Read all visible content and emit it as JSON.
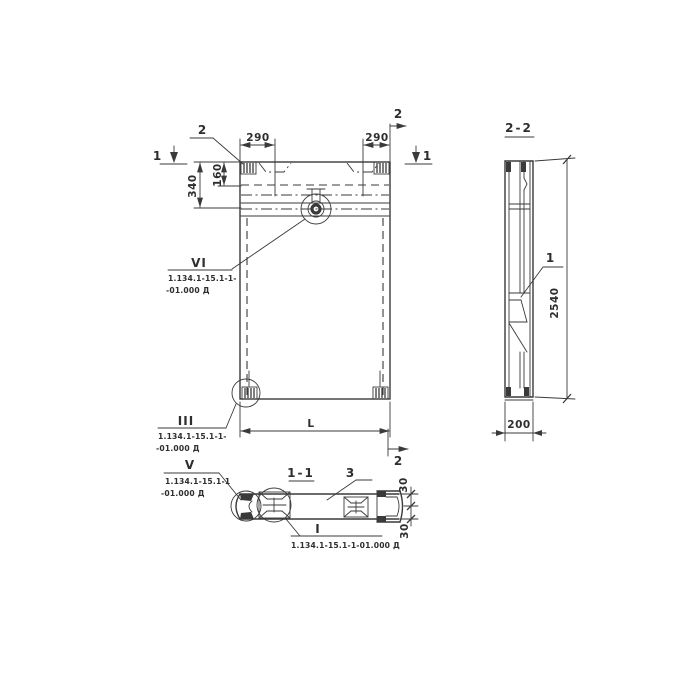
{
  "colors": {
    "ink": "#3a3a3a",
    "paper": "#ffffff"
  },
  "front": {
    "leader_label_2": "2",
    "dim_290_left": "290",
    "dim_290_right": "290",
    "dim_160": "160",
    "dim_340": "340",
    "dim_length": "L",
    "mark_1_left": "1",
    "mark_1_right": "1",
    "mark_2_top": "2",
    "mark_2_bottom": "2"
  },
  "section_2_2": {
    "title": "2-2",
    "dim_height": "2540",
    "dim_width": "200",
    "callout_1": "1"
  },
  "section_1_1": {
    "title": "1-1",
    "callout_3": "3",
    "dim_30_top": "30",
    "dim_30_bottom": "30"
  },
  "details": {
    "vi": {
      "label": "VI",
      "ref_line1": "1.134.1-15.1-1-",
      "ref_line2": "-01.000 Д"
    },
    "iii": {
      "label": "III",
      "ref_line1": "1.134.1-15.1-1-",
      "ref_line2": "-01.000 Д"
    },
    "v": {
      "label": "V",
      "ref_line1": "1.134.1-15.1-1",
      "ref_line2": "-01.000 Д"
    },
    "i": {
      "label": "I",
      "ref": "1.134.1-15.1-1-01.000 Д"
    }
  }
}
